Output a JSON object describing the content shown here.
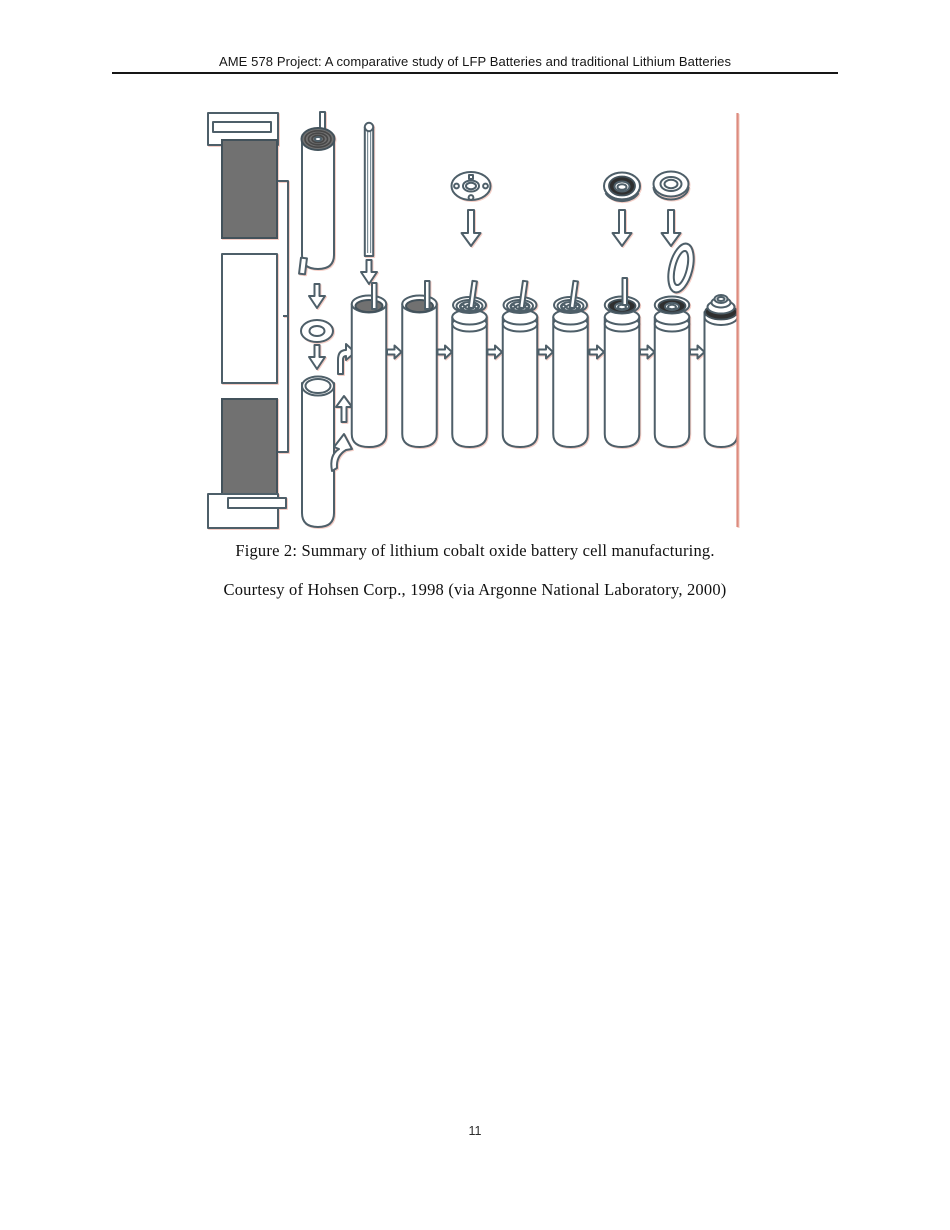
{
  "header": {
    "title": "AME 578 Project: A comparative study of LFP Batteries and traditional Lithium Batteries"
  },
  "figure": {
    "caption_line1": "Figure 2: Summary of lithium cobalt oxide battery cell manufacturing.",
    "caption_line2": "Courtesy of Hohsen Corp., 1998 (via Argonne National Laboratory, 2000)",
    "colors": {
      "outline": "#4e5f69",
      "electrode_fill": "#717171",
      "gasket_dark": "#2f2f2f",
      "reference_line": "#dd8b7e"
    }
  },
  "footer": {
    "page_number": "11"
  }
}
